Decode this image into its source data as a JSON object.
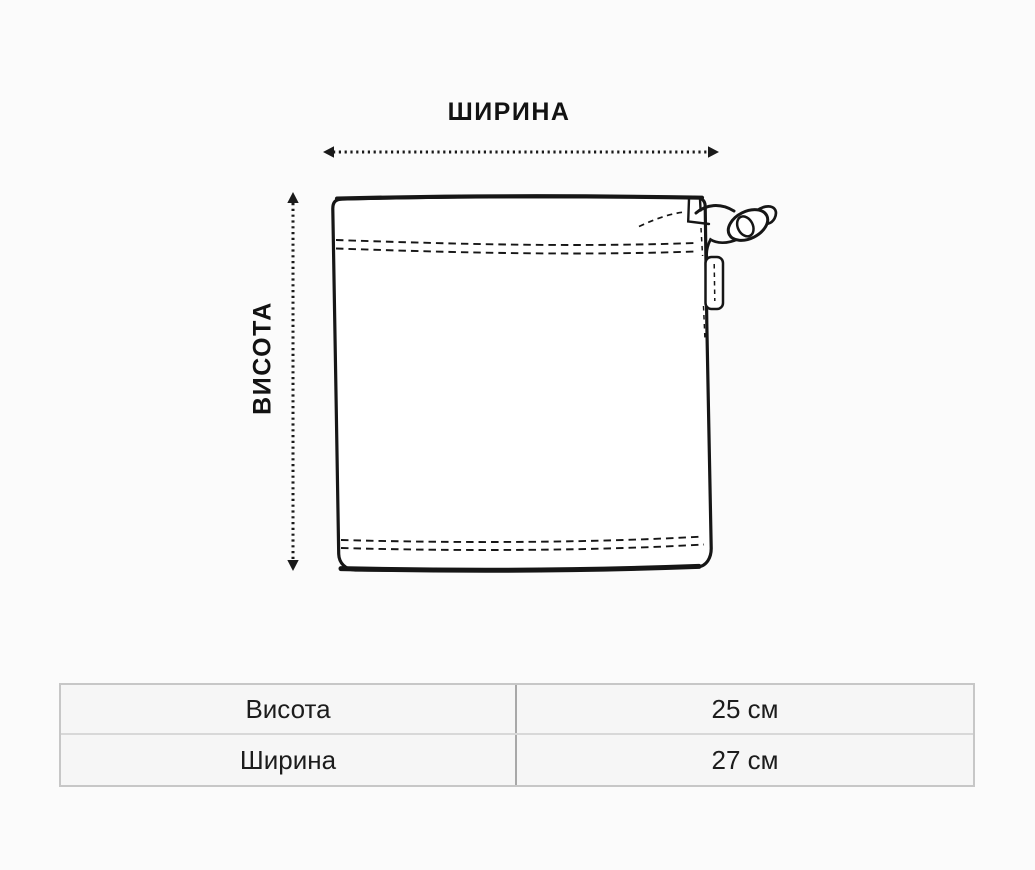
{
  "diagram": {
    "width_label": "ШИРИНА",
    "height_label": "ВИСОТА",
    "subject": "drawstring-pouch"
  },
  "size_table": {
    "rows": [
      {
        "label": "Висота",
        "value": "25 см"
      },
      {
        "label": "Ширина",
        "value": "27 см"
      }
    ]
  },
  "colors": {
    "background": "#fbfbfb",
    "line": "#161616",
    "bag_fill": "#ffffff",
    "table_outer_border": "#c7c7c7",
    "table_row_divider": "#d8d8d8",
    "table_column_divider": "#a8a8a8",
    "table_cell_background": "#f6f6f6",
    "text": "#1c1c1c"
  }
}
